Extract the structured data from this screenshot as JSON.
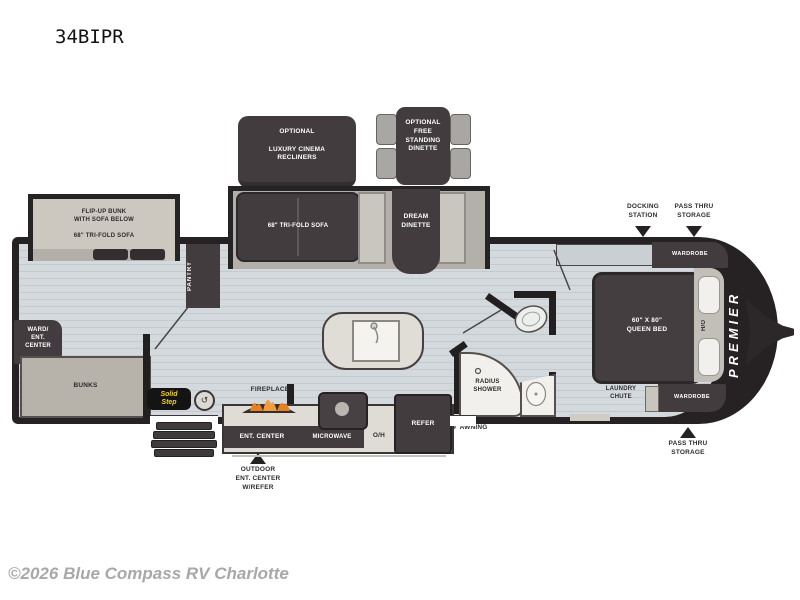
{
  "title": "34BIPR",
  "copyright": "©2026 Blue Compass RV Charlotte",
  "brand": "PREMIER",
  "options": {
    "recliners": [
      "OPTIONAL",
      "LUXURY CINEMA",
      "RECLINERS"
    ],
    "dinette": [
      "OPTIONAL",
      "FREE",
      "STANDING",
      "DINETTE"
    ]
  },
  "slides": {
    "bunk": [
      "FLIP-UP BUNK",
      "WITH SOFA BELOW",
      "68\" TRI-FOLD SOFA"
    ],
    "sofa": "68\" TRI-FOLD SOFA",
    "dinette": [
      "DREAM",
      "DINETTE"
    ]
  },
  "rooms": {
    "pantry": "PANTRY",
    "ward": [
      "WARD/",
      "ENT.",
      "CENTER"
    ],
    "bunks": "BUNKS",
    "shower": [
      "RADIUS",
      "SHOWER"
    ],
    "bed": [
      "60\" X 80\"",
      "QUEEN BED"
    ],
    "ho": "H/O",
    "wardrobe_top": "WARDROBE",
    "wardrobe_bottom": "WARDROBE",
    "laundry": [
      "LAUNDRY",
      "CHUTE"
    ]
  },
  "kitchen": {
    "fireplace": "FIREPLACE",
    "ent_center": "ENT. CENTER",
    "microwave": "MICROWAVE",
    "oh": "O/H",
    "refer": "REFER",
    "awning": "19' AWNING"
  },
  "callouts": {
    "docking": [
      "DOCKING",
      "STATION"
    ],
    "pass_thru_top": [
      "PASS THRU",
      "STORAGE"
    ],
    "pass_thru_bottom": [
      "PASS THRU",
      "STORAGE"
    ],
    "outdoor": [
      "OUTDOOR",
      "ENT. CENTER",
      "W/REFER"
    ]
  },
  "badges": {
    "solid_step": [
      "Solid",
      "Step"
    ]
  },
  "colors": {
    "shell": "#262223",
    "wall": "#211f20",
    "furniture_dark": "#423c3e",
    "floor": "#d3d9dc",
    "slide_light": "#ccc8c0",
    "accent_yellow": "#f5d01f",
    "flame_orange": "#e8821e",
    "watermark_gray": "#a8a8a8"
  }
}
